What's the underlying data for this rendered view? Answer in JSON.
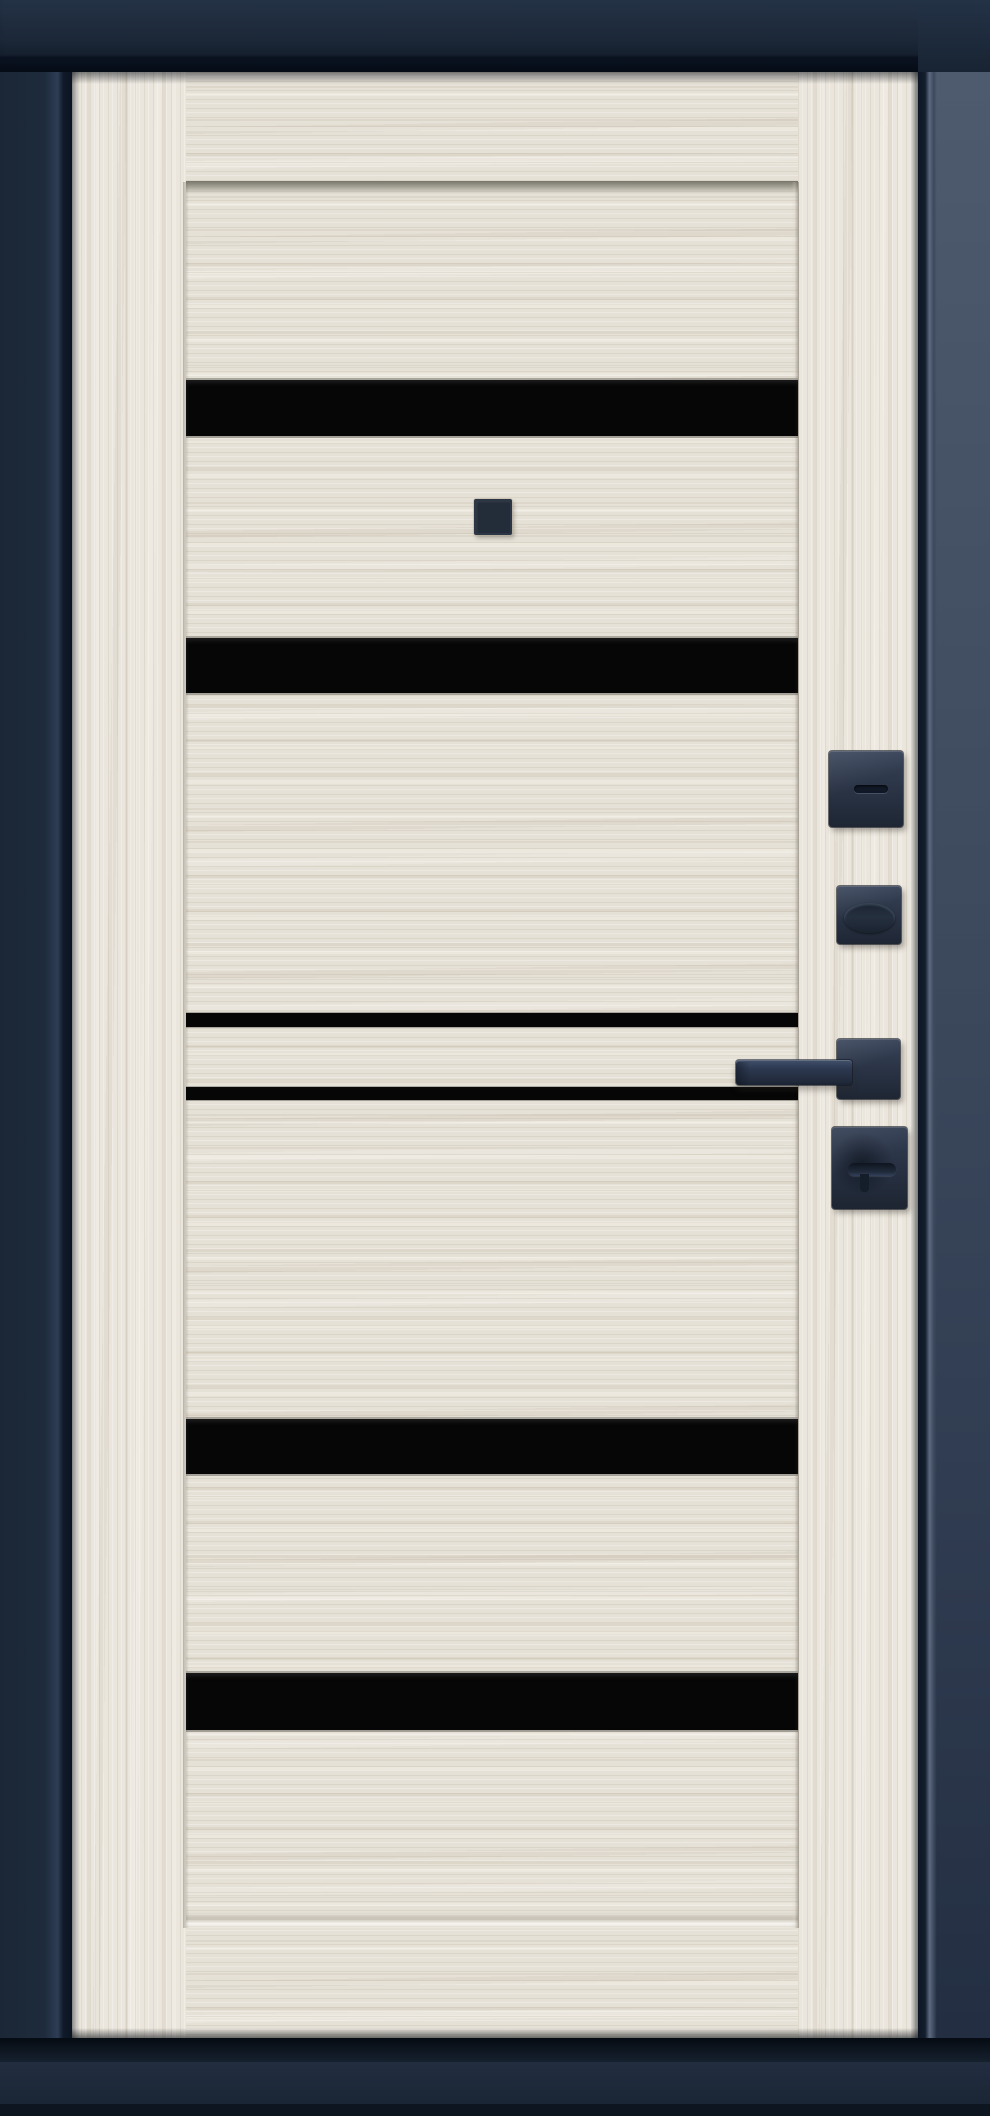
{
  "scene": {
    "description": "Front view of a closed entrance door: light ash-wood slab with horizontal black glass inserts and matte dark square hardware, mounted in a dark navy steel frame",
    "frame": {
      "color": "#1c2838",
      "right_jamb_top_color": "#4e5a6e",
      "right_jamb_bottom_color": "#232e42",
      "sill_color": "#1e2937"
    },
    "slab": {
      "wood_base_color": "#e6e1d7",
      "stile_wood_color": "#ebe6dd",
      "grain_dark_color": "#c9c0ae",
      "grain_light_color": "#f4f0e8",
      "bevel_color": "#a5a296"
    },
    "glass_inserts": {
      "color": "#060606",
      "count": 6,
      "wide_count": 4,
      "narrow_count": 2
    },
    "peephole": {
      "color": "#232c39"
    },
    "hardware": {
      "color": "#2a3548",
      "highlight_color": "#41506a",
      "shadow_color": "#111927",
      "items": [
        "deadbolt-escutcheon",
        "cylinder-escutcheon",
        "lever-handle",
        "thumbturn-escutcheon"
      ]
    }
  }
}
